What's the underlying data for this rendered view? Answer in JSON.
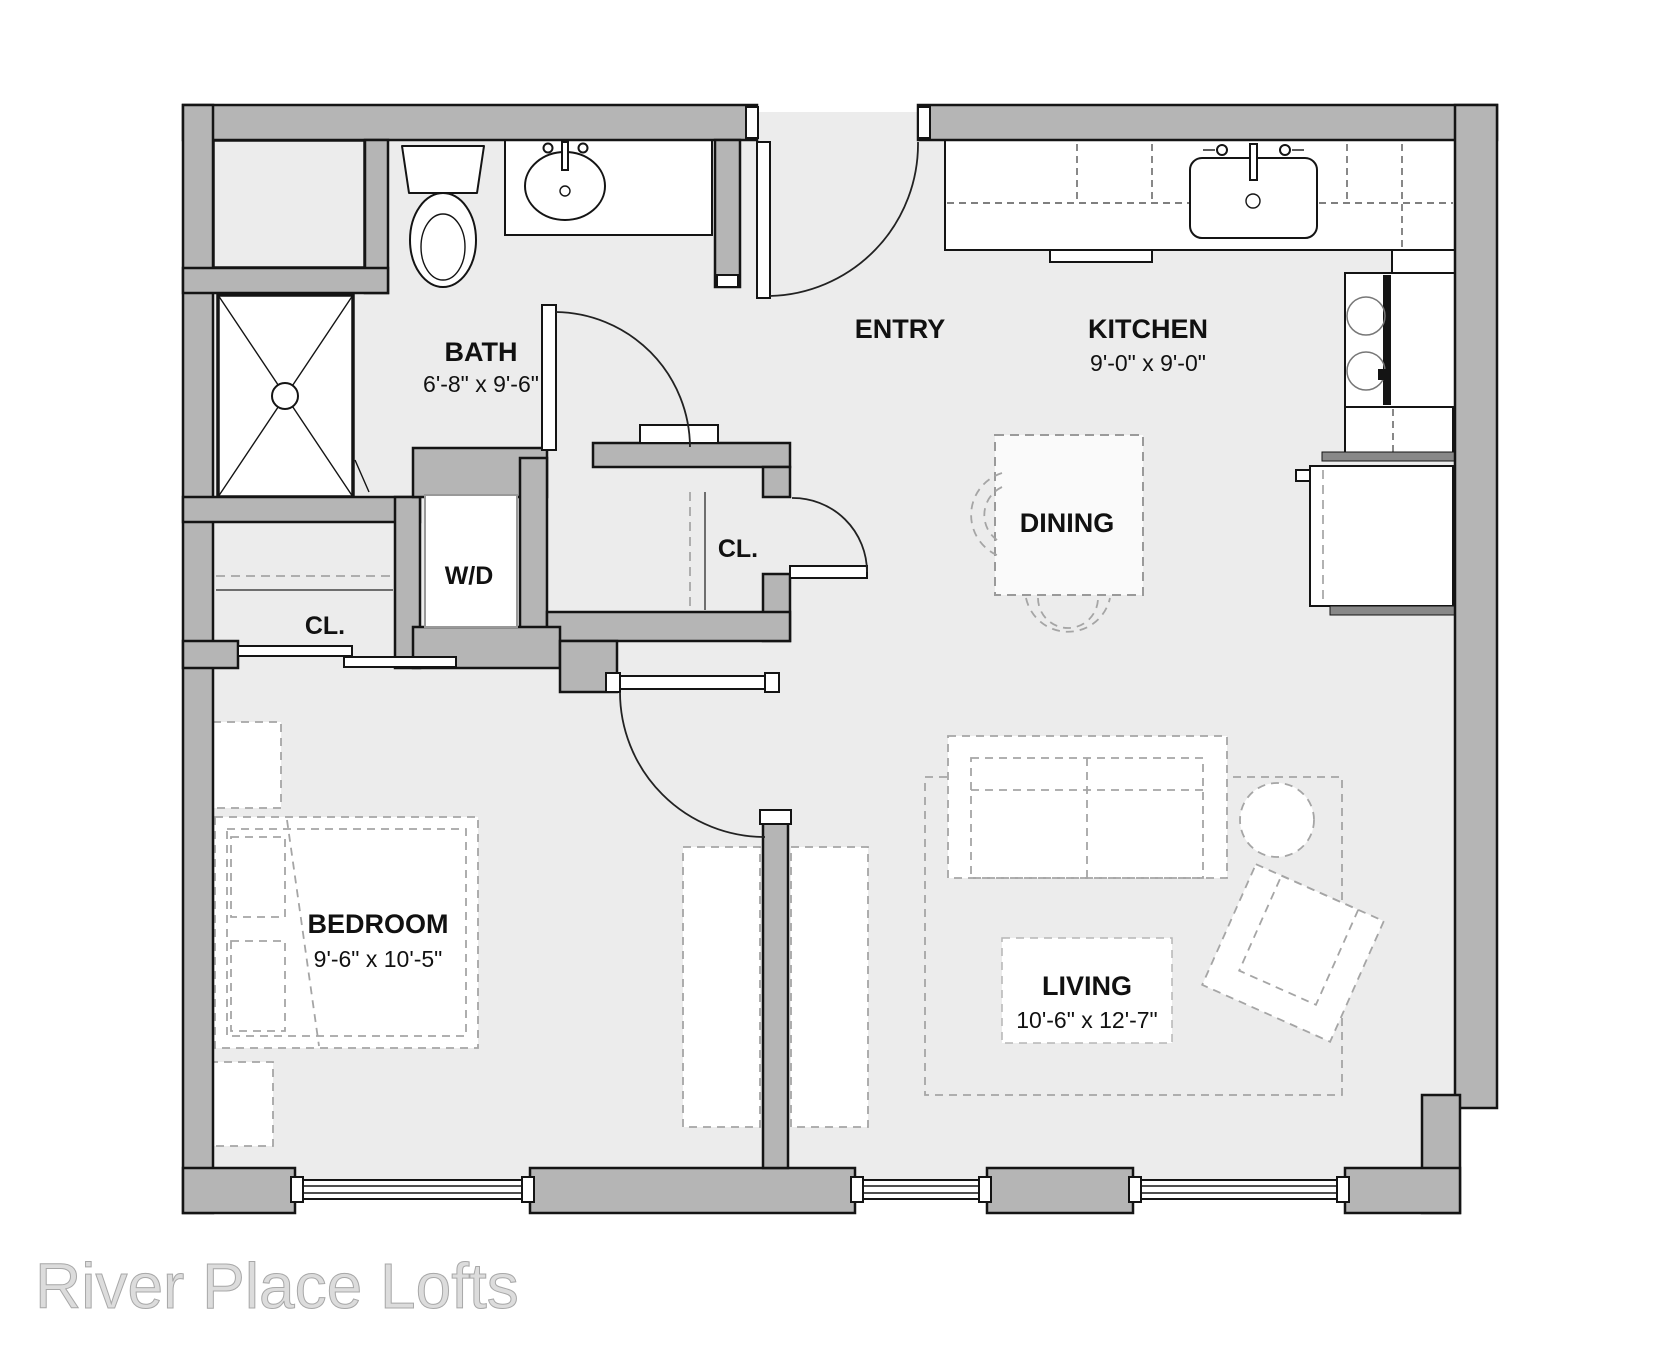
{
  "title": "River Place Lofts",
  "colors": {
    "wall": "#b5b5b5",
    "floor": "#ececec",
    "line": "#141414",
    "furniture_dash": "#a5a5a5",
    "title_text": "#dcdcdc"
  },
  "rooms": {
    "bath": {
      "name": "BATH",
      "dims": "6'-8\" x 9'-6\""
    },
    "entry": {
      "name": "ENTRY"
    },
    "kitchen": {
      "name": "KITCHEN",
      "dims": "9'-0\" x 9'-0\""
    },
    "dining": {
      "name": "DINING"
    },
    "bedroom": {
      "name": "BEDROOM",
      "dims": "9'-6\" x 10'-5\""
    },
    "living": {
      "name": "LIVING",
      "dims": "10'-6\" x 12'-7\""
    }
  },
  "fixtures": {
    "washer_dryer": "W/D",
    "closet_bedroom": "CL.",
    "closet_entry": "CL."
  }
}
